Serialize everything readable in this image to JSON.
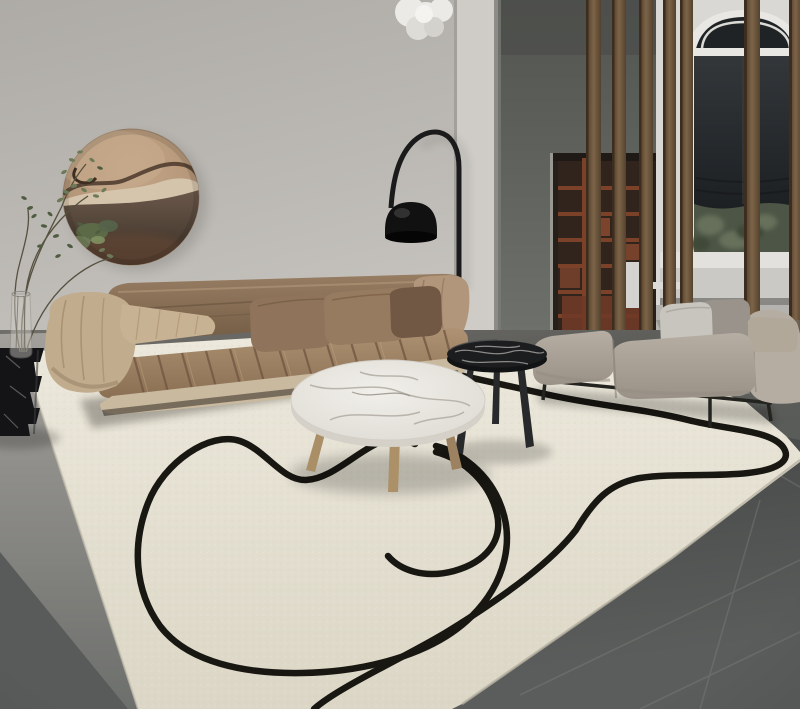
{
  "meta": {
    "type": "interior-photograph",
    "title": "Modern living room with ivory line-art area rug",
    "width_px": 800,
    "height_px": 709
  },
  "scene": {
    "setting": "Minimalist living room: taupe channel-tufted sofa, round marble coffee table, black marble side table, gray bench, walnut slat room divider, arched window, circular driftwood wall art, arc floor lamp, ivory rug with abstract black lines on dark gray tile floor",
    "objects": [
      {
        "name": "wall-art",
        "label": "Round driftwood wall art"
      },
      {
        "name": "plant",
        "label": "Branch arrangement in glass vase"
      },
      {
        "name": "sculpture-table",
        "label": "Black marble sculptural pedestal table"
      },
      {
        "name": "arc-lamp",
        "label": "Black arc floor lamp"
      },
      {
        "name": "pendant-light",
        "label": "White cloud pendant light"
      },
      {
        "name": "brown-sofa",
        "label": "Channel-tufted taupe fabric sofa with pillows"
      },
      {
        "name": "coffee-table",
        "label": "Round white marble coffee table with wood legs"
      },
      {
        "name": "side-table",
        "label": "Round black marble side table"
      },
      {
        "name": "bench-sofa",
        "label": "Gray upholstered bench sofa with cushions"
      },
      {
        "name": "divider-slats",
        "label": "Walnut vertical slat room divider"
      },
      {
        "name": "bookshelf",
        "label": "Recessed red-brown bookshelf"
      },
      {
        "name": "arched-window",
        "label": "Tall arched window with dark roller shade"
      },
      {
        "name": "area-rug",
        "label": "Ivory area rug with abstract black line pattern"
      },
      {
        "name": "tile-floor",
        "label": "Dark gray tile floor"
      }
    ]
  },
  "palette": {
    "wall": "#b9b6b1",
    "wall-light": "#c8c5c0",
    "column": "#cfccc7",
    "partition": "#5f615d",
    "partition-dark": "#4b4d4a",
    "shelf-wood": "#7b4129",
    "shelf-dark": "#26201b",
    "shelf-accent": "#8a4a30",
    "window-wall": "#dad8d4",
    "window-frame": "#e9e7e3",
    "shade": "#23262a",
    "greenery": "#4d5646",
    "greenery-light": "#66705a",
    "sill": "#e3e1dd",
    "sill-front": "#cbc9c5",
    "slat": "#6f5840",
    "pendant": "#eceae6",
    "art-tan": "#b79979",
    "art-cream": "#d8cbb4",
    "art-dark": "#46382c",
    "art-rust": "#6b4a34",
    "moss": "#5e6d49",
    "lamp-black": "#1b1b1b",
    "sofa-brown": "#93795e",
    "sofa-brown-dark": "#755e47",
    "seat-brown": "#a4886a",
    "seat-shadow": "#6f5540",
    "arm-tan": "#c2ac8e",
    "arm-cream": "#c9b99e",
    "arm-roll": "#b2967b",
    "pillow-tan-1": "#8f745b",
    "pillow-tan-2": "#977b60",
    "pillow-dark": "#715844",
    "marble": "#eceae5",
    "marble-vein": "#b0aca3",
    "wood-leg": "#ab9068",
    "table-black": "#1c1d1f",
    "bench-gray": "#aba298",
    "bench-gray-light": "#b5ada2",
    "bench-front": "#968e83",
    "pillow-light-gray": "#c8c4be",
    "pillow-gray": "#99938b",
    "pillow-beige": "#b2a89a",
    "metal-black": "#23231f",
    "rug": "#e9e5d8",
    "rug-deep": "#dcd7c6",
    "rug-line": "#191712",
    "floor-light": "#a09d98",
    "floor-mid": "#75746f",
    "floor-dark": "#474948",
    "floor-seam": "#7e807d",
    "sculpture-black": "#141416",
    "glass": "#cfccc6",
    "stem": "#55503f",
    "leaf": "#6c7a58",
    "leaf-dark": "#4f5c41",
    "white-chair": "#d5d3cf"
  }
}
